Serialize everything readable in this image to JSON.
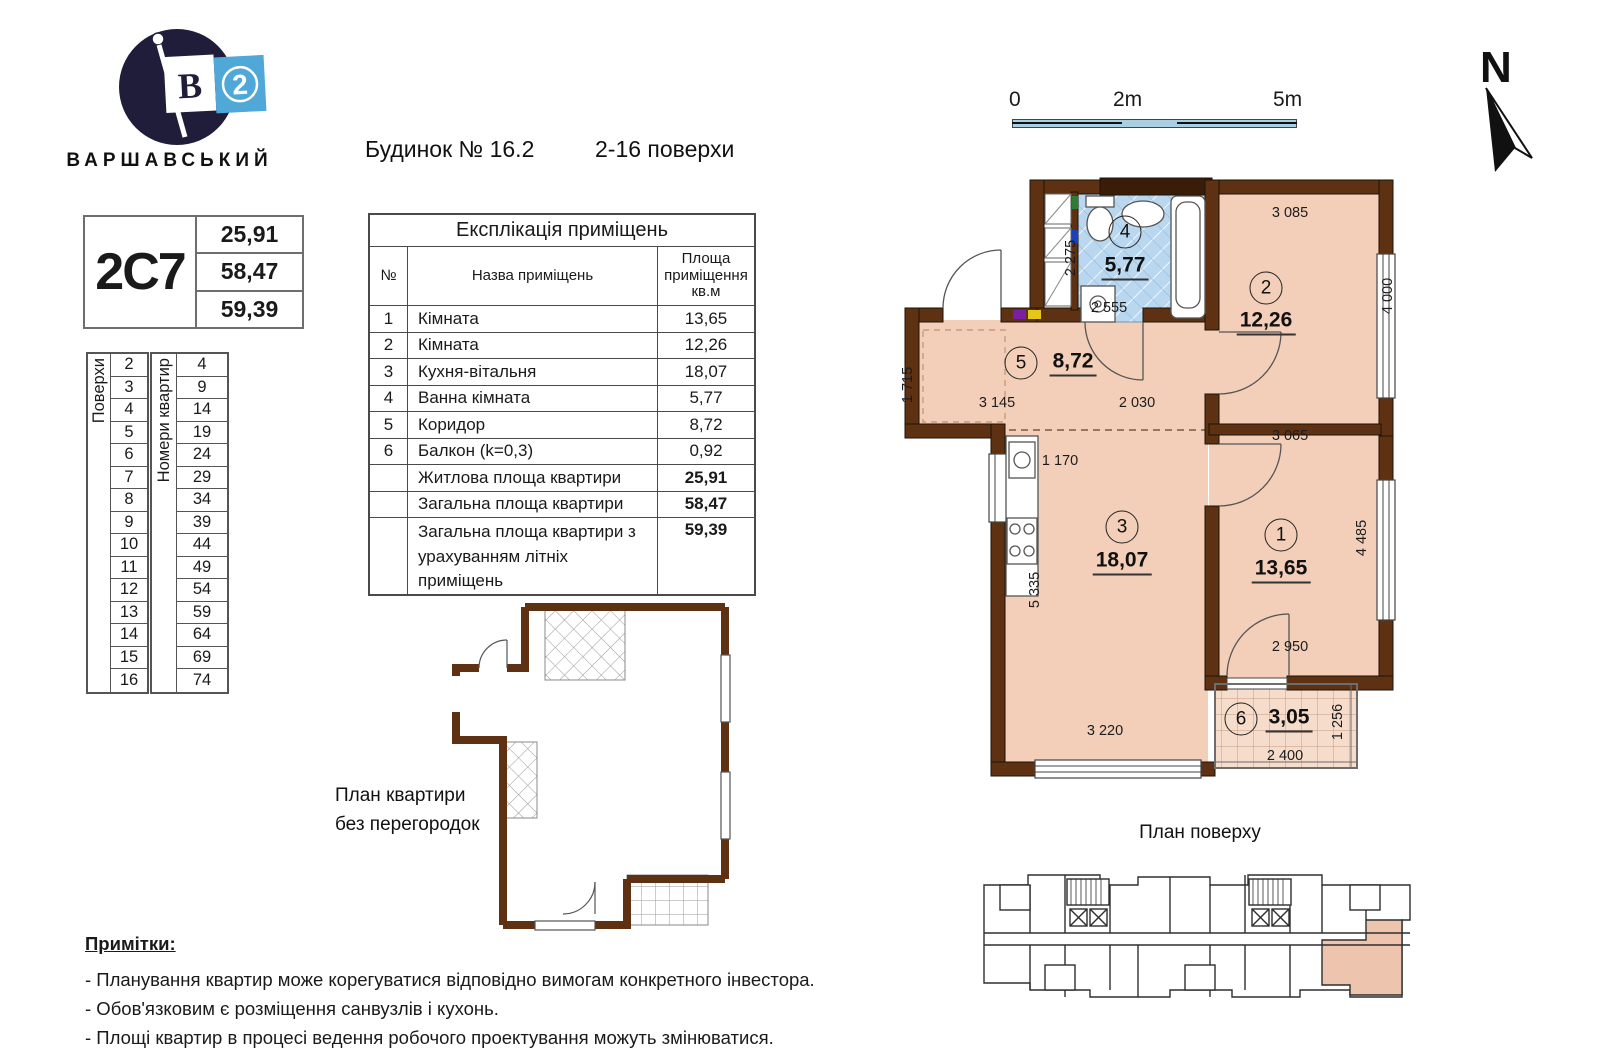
{
  "logo": {
    "brand": "ВАРШАВСЬКИЙ",
    "flag_letter": "В",
    "flag_number": "2"
  },
  "header": {
    "building": "Будинок № 16.2",
    "floors_range": "2-16 поверхи"
  },
  "apartment_card": {
    "code": "2С7",
    "living_area": "25,91",
    "total_area": "58,47",
    "total_with_summer": "59,39"
  },
  "floors_table": {
    "label": "Поверхи",
    "values": [
      "2",
      "3",
      "4",
      "5",
      "6",
      "7",
      "8",
      "9",
      "10",
      "11",
      "12",
      "13",
      "14",
      "15",
      "16"
    ]
  },
  "apartments_table": {
    "label": "Номери квартир",
    "values": [
      "4",
      "9",
      "14",
      "19",
      "24",
      "29",
      "34",
      "39",
      "44",
      "49",
      "54",
      "59",
      "64",
      "69",
      "74"
    ]
  },
  "explication": {
    "title": "Експлікація приміщень",
    "col_no": "№",
    "col_name": "Назва приміщень",
    "col_area": "Площа приміщення кв.м",
    "rows": [
      {
        "no": "1",
        "name": "Кімната",
        "area": "13,65"
      },
      {
        "no": "2",
        "name": "Кімната",
        "area": "12,26"
      },
      {
        "no": "3",
        "name": "Кухня-вітальня",
        "area": "18,07"
      },
      {
        "no": "4",
        "name": "Ванна кімната",
        "area": "5,77"
      },
      {
        "no": "5",
        "name": "Коридор",
        "area": "8,72"
      },
      {
        "no": "6",
        "name": "Балкон (k=0,3)",
        "area": "0,92"
      }
    ],
    "totals": [
      {
        "name": "Житлова площа квартири",
        "area": "25,91",
        "tall": false
      },
      {
        "name": "Загальна площа квартири",
        "area": "58,47",
        "tall": false
      },
      {
        "name": "Загальна площа квартири з урахуванням літніх приміщень",
        "area": "59,39",
        "tall": true
      }
    ]
  },
  "scalebar": {
    "t0": "0",
    "t2": "2m",
    "t5": "5m"
  },
  "north": {
    "label": "N"
  },
  "plan": {
    "rooms": [
      {
        "num": "4",
        "area": "5,77",
        "cx": 240,
        "cy": 62,
        "ax": 240,
        "ay": 97
      },
      {
        "num": "2",
        "area": "12,26",
        "cx": 381,
        "cy": 118,
        "ax": 381,
        "ay": 152
      },
      {
        "num": "5",
        "area": "8,72",
        "cx": 136,
        "cy": 193,
        "ax": 188,
        "ay": 193
      },
      {
        "num": "3",
        "area": "18,07",
        "cx": 237,
        "cy": 357,
        "ax": 237,
        "ay": 392
      },
      {
        "num": "1",
        "area": "13,65",
        "cx": 396,
        "cy": 365,
        "ax": 396,
        "ay": 400
      },
      {
        "num": "6",
        "area": "3,05",
        "cx": 356,
        "cy": 549,
        "ax": 404,
        "ay": 549
      }
    ],
    "dims": [
      {
        "t": "3 085",
        "x": 405,
        "y": 43,
        "r": 0
      },
      {
        "t": "4 000",
        "x": 503,
        "y": 126,
        "r": 1
      },
      {
        "t": "2 275",
        "x": 186,
        "y": 88,
        "r": 1
      },
      {
        "t": "2 555",
        "x": 224,
        "y": 138,
        "r": 0
      },
      {
        "t": "1 715",
        "x": 23,
        "y": 215,
        "r": 1
      },
      {
        "t": "3 145",
        "x": 112,
        "y": 233,
        "r": 0
      },
      {
        "t": "2 030",
        "x": 252,
        "y": 233,
        "r": 0
      },
      {
        "t": "3 065",
        "x": 405,
        "y": 266,
        "r": 0
      },
      {
        "t": "1 170",
        "x": 175,
        "y": 291,
        "r": 0
      },
      {
        "t": "5 335",
        "x": 150,
        "y": 420,
        "r": 1
      },
      {
        "t": "4 485",
        "x": 477,
        "y": 368,
        "r": 1
      },
      {
        "t": "2 950",
        "x": 405,
        "y": 477,
        "r": 0
      },
      {
        "t": "3 220",
        "x": 220,
        "y": 561,
        "r": 0
      },
      {
        "t": "2 400",
        "x": 400,
        "y": 586,
        "r": 0
      },
      {
        "t": "1 256",
        "x": 453,
        "y": 552,
        "r": 1
      }
    ]
  },
  "no_partitions_label": {
    "line1": "План квартири",
    "line2": "без перегородок"
  },
  "floor_plan_label": "План поверху",
  "notes": {
    "title": "Примітки:",
    "items": [
      "- Планування квартир може корегуватися відповідно вимогам конкретного інвестора.",
      "- Обов'язковим є розміщення санвузлів і кухонь.",
      "- Площі квартир в процесі ведення робочого проектування можуть змінюватися."
    ]
  },
  "colors": {
    "wall": "#5e3113",
    "wall_dark": "#3a1d08",
    "floor": "#f3cfba",
    "bath": "#b9d7ef",
    "balcony": "#f6dccb",
    "navy": "#201d3a",
    "brand_blue": "#4fa8d8",
    "highlight": "#edc5ae"
  }
}
